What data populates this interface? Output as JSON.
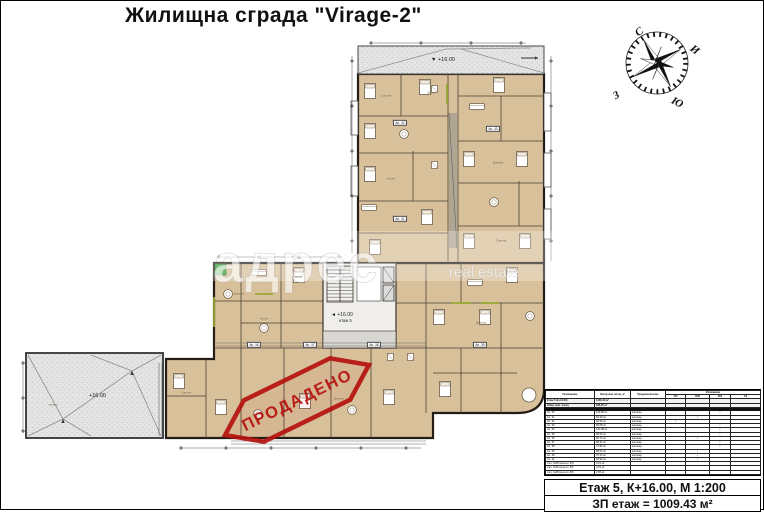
{
  "title": "Жилищна сграда \"Virage-2\"",
  "compass": {
    "north": "С",
    "east": "И",
    "south": "Ю",
    "west": "З"
  },
  "watermark": {
    "main": "адрес",
    "sub": "real estate"
  },
  "stamp": {
    "text": "ПРОДАДЕНО",
    "color": "#b5120e"
  },
  "plan": {
    "roof_top_elevation": "▼ +16.00",
    "roof_left_elevation": "+16.00",
    "core_elevation": "◄ +16.00",
    "core_floor": "етаж 5",
    "roof_label": "тераса",
    "colors": {
      "room_fill": "#d8c09a",
      "wall": "#231d16",
      "roof_fill": "#e3e3e3",
      "accent_olive": "#9aa832",
      "marker_green": "#35a43a"
    },
    "room_labels": [
      {
        "text": "Спалня",
        "x": 385,
        "y": 95
      },
      {
        "text": "Баня",
        "x": 430,
        "y": 92
      },
      {
        "text": "Дневна",
        "x": 497,
        "y": 162
      },
      {
        "text": "Спалня",
        "x": 500,
        "y": 240
      },
      {
        "text": "Кухня",
        "x": 390,
        "y": 178
      },
      {
        "text": "Дневна",
        "x": 238,
        "y": 293
      },
      {
        "text": "Кухня",
        "x": 263,
        "y": 318
      },
      {
        "text": "Спалня",
        "x": 296,
        "y": 276
      },
      {
        "text": "Дневна",
        "x": 480,
        "y": 322
      },
      {
        "text": "Спалня",
        "x": 185,
        "y": 392
      },
      {
        "text": "Дневна",
        "x": 338,
        "y": 398
      },
      {
        "text": "тераса",
        "x": 52,
        "y": 404
      }
    ],
    "apartment_plates": [
      {
        "text": "Ап. 36",
        "x": 253,
        "y": 344
      },
      {
        "text": "Ап. 37",
        "x": 309,
        "y": 344
      },
      {
        "text": "Ап. 38",
        "x": 373,
        "y": 344
      },
      {
        "text": "Ап. 39",
        "x": 479,
        "y": 344
      },
      {
        "text": "Ап. 42",
        "x": 399,
        "y": 122
      },
      {
        "text": "Ап. 43",
        "x": 492,
        "y": 128
      },
      {
        "text": "Ап. 41",
        "x": 399,
        "y": 218
      }
    ]
  },
  "table": {
    "header": {
      "col1": "Помещение",
      "col2": "Застроена площ, м²",
      "col3": "Предназначение",
      "group": "Изложение",
      "sub": [
        "СИ",
        "ЮИ",
        "ЮЗ",
        "СЗ"
      ]
    },
    "summary_rows": [
      [
        "Етаж 5 (К+16.00)",
        "1009.43 м²",
        "",
        "",
        "",
        "",
        ""
      ],
      [
        "Общо жил. площ",
        "846.25 м²",
        "",
        "",
        "",
        "",
        ""
      ]
    ],
    "rows": [
      [
        "Ап. 30",
        "109.56 м²",
        "жилище",
        "",
        "",
        "•",
        ""
      ],
      [
        "Ап. 31",
        "84.29 м²",
        "жилище",
        "",
        "•",
        "",
        ""
      ],
      [
        "Ап. 32",
        "66.54 м²",
        "жилище",
        "•",
        "",
        "",
        ""
      ],
      [
        "Ап. 33",
        "66.08 м²",
        "жилище",
        "",
        "",
        "•",
        ""
      ],
      [
        "Ап. 34",
        "101.88 м²",
        "жилище",
        "",
        "",
        "•",
        ""
      ],
      [
        "Ап. 35",
        "96.62 м²",
        "жилище",
        "",
        "",
        "•",
        ""
      ],
      [
        "Ап. 36",
        "85.74 м²",
        "жилище",
        "",
        "•",
        "",
        ""
      ],
      [
        "Ап. 37",
        "68.41 м²",
        "жилище",
        "",
        "",
        "•",
        ""
      ],
      [
        "Ап. 38",
        "74.95 м²",
        "жилище",
        "",
        "",
        "•",
        ""
      ],
      [
        "Ап. 39",
        "88.03 м²",
        "жилище",
        "",
        "•",
        "",
        ""
      ],
      [
        "Ап. 40",
        "72.14 м²",
        "жилище",
        "",
        "•",
        "",
        ""
      ],
      [
        "Ап. 41",
        "66.93 м²",
        "жилище",
        "",
        "•",
        "",
        ""
      ]
    ],
    "storage_rows": [
      [
        "Скл. №35 (към ап. 35)",
        "3.21 м²",
        "",
        "",
        "",
        "",
        ""
      ],
      [
        "Скл. №36 (към ап. 36)",
        "3.34 м²",
        "",
        "",
        "",
        "",
        ""
      ],
      [
        "Скл. №38 (към ап. 38)",
        "2.95 м²",
        "",
        "",
        "",
        "",
        ""
      ]
    ]
  },
  "footer": {
    "line1": "Етаж 5, К+16.00, М 1:200",
    "line2": "ЗП етаж = 1009.43 м²"
  }
}
